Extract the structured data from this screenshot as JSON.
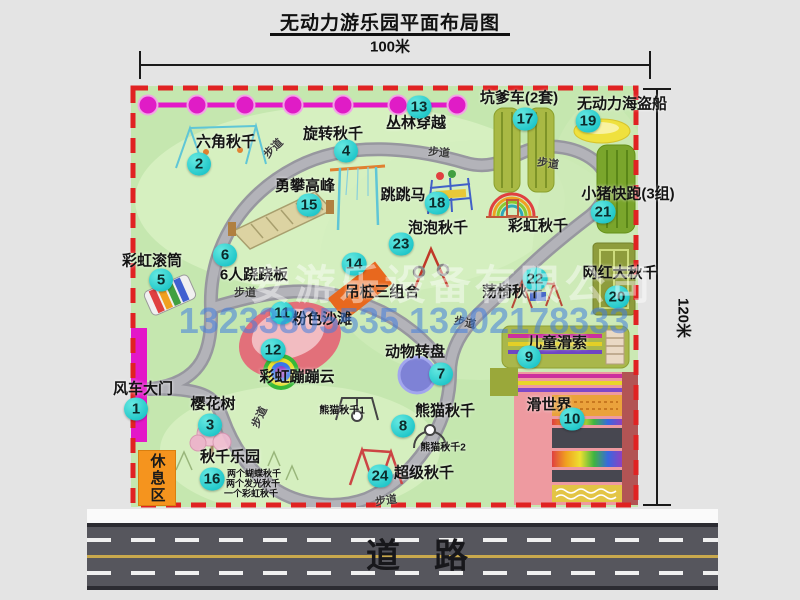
{
  "title": "无动力游乐园平面布局图",
  "dim_top": "100米",
  "dim_right": "120米",
  "road": {
    "label": "道路"
  },
  "watermark": {
    "line1": "安游乐设备有限公司",
    "line2": "13233805535 13202178333"
  },
  "rest_area_label": "休息区",
  "colors": {
    "map_green": "#c5e7af",
    "path_gray": "#a6a6ac",
    "boundary_red": "#e02222",
    "badge_cyan": "#2fd8d2",
    "gate_magenta": "#e318c8",
    "rest_orange": "#f5941e",
    "road_gray": "#56565d"
  },
  "attractions": [
    {
      "num": 1,
      "name": "风车大门",
      "bx": 136,
      "by": 409,
      "lx": 143,
      "ly": 388
    },
    {
      "num": 2,
      "name": "六角秋千",
      "bx": 199,
      "by": 164,
      "lx": 226,
      "ly": 141
    },
    {
      "num": 3,
      "name": "樱花树",
      "bx": 210,
      "by": 425,
      "lx": 213,
      "ly": 403
    },
    {
      "num": 4,
      "name": "旋转秋千",
      "bx": 346,
      "by": 151,
      "lx": 333,
      "ly": 133
    },
    {
      "num": 5,
      "name": "彩虹滚筒",
      "bx": 161,
      "by": 280,
      "lx": 152,
      "ly": 260
    },
    {
      "num": 6,
      "name": "6人跷跷板",
      "bx": 225,
      "by": 255,
      "lx": 254,
      "ly": 274
    },
    {
      "num": 7,
      "name": "动物转盘",
      "bx": 441,
      "by": 374,
      "lx": 415,
      "ly": 351
    },
    {
      "num": 8,
      "name": "熊猫秋千",
      "bx": 403,
      "by": 426,
      "lx": 445,
      "ly": 410
    },
    {
      "num": 9,
      "name": "儿童滑索",
      "bx": 529,
      "by": 357,
      "lx": 557,
      "ly": 342
    },
    {
      "num": 10,
      "name": "滑世界",
      "bx": 572,
      "by": 419,
      "lx": 549,
      "ly": 404
    },
    {
      "num": 11,
      "name": "粉色沙滩",
      "bx": 282,
      "by": 313,
      "lx": 322,
      "ly": 318
    },
    {
      "num": 12,
      "name": "彩虹蹦蹦云",
      "bx": 273,
      "by": 350,
      "lx": 297,
      "ly": 376
    },
    {
      "num": 13,
      "name": "丛林穿越",
      "bx": 419,
      "by": 107,
      "lx": 416,
      "ly": 122
    },
    {
      "num": 14,
      "name": "吊桩三组合",
      "bx": 354,
      "by": 264,
      "lx": 382,
      "ly": 291
    },
    {
      "num": 15,
      "name": "勇攀高峰",
      "bx": 309,
      "by": 205,
      "lx": 305,
      "ly": 185
    },
    {
      "num": 16,
      "name": "秋千乐园",
      "bx": 212,
      "by": 479,
      "lx": 230,
      "ly": 456
    },
    {
      "num": 17,
      "name": "坑爹车(2套)",
      "bx": 525,
      "by": 119,
      "lx": 519,
      "ly": 97
    },
    {
      "num": 18,
      "name": "跳跳马",
      "bx": 437,
      "by": 203,
      "lx": 403,
      "ly": 194
    },
    {
      "num": 19,
      "name": "无动力海盗船",
      "bx": 588,
      "by": 121,
      "lx": 622,
      "ly": 103
    },
    {
      "num": 20,
      "name": "网红大秋千",
      "bx": 617,
      "by": 297,
      "lx": 620,
      "ly": 272
    },
    {
      "num": 21,
      "name": "小猪快跑(3组)",
      "bx": 603,
      "by": 212,
      "lx": 628,
      "ly": 193
    },
    {
      "num": 22,
      "name": "荡椅秋千",
      "bx": 535,
      "by": 279,
      "lx": 512,
      "ly": 291
    },
    {
      "num": 23,
      "name": "泡泡秋千",
      "bx": 401,
      "by": 244,
      "lx": 438,
      "ly": 227
    },
    {
      "num": 24,
      "name": "超级秋千",
      "bx": 380,
      "by": 476,
      "lx": 424,
      "ly": 472
    }
  ],
  "extra_labels": [
    {
      "text": "彩虹秋千",
      "x": 538,
      "y": 225,
      "fs": 15
    },
    {
      "text": "熊猫秋千1",
      "x": 342,
      "y": 409,
      "fs": 10
    },
    {
      "text": "熊猫秋千2",
      "x": 443,
      "y": 446,
      "fs": 10
    },
    {
      "text": "两个蝴蝶秋千",
      "x": 254,
      "y": 473,
      "fs": 9
    },
    {
      "text": "两个发光秋千",
      "x": 253,
      "y": 483,
      "fs": 9
    },
    {
      "text": "一个彩虹秋千",
      "x": 251,
      "y": 493,
      "fs": 9
    }
  ],
  "path_labels": [
    {
      "text": "步道",
      "x": 273,
      "y": 148,
      "rot": -45
    },
    {
      "text": "步道",
      "x": 439,
      "y": 152,
      "rot": 5
    },
    {
      "text": "步道",
      "x": 548,
      "y": 163,
      "rot": 8
    },
    {
      "text": "步道",
      "x": 245,
      "y": 292,
      "rot": 0
    },
    {
      "text": "步道",
      "x": 465,
      "y": 322,
      "rot": 12
    },
    {
      "text": "步道",
      "x": 259,
      "y": 417,
      "rot": -65
    },
    {
      "text": "步道",
      "x": 386,
      "y": 500,
      "rot": -8
    }
  ]
}
